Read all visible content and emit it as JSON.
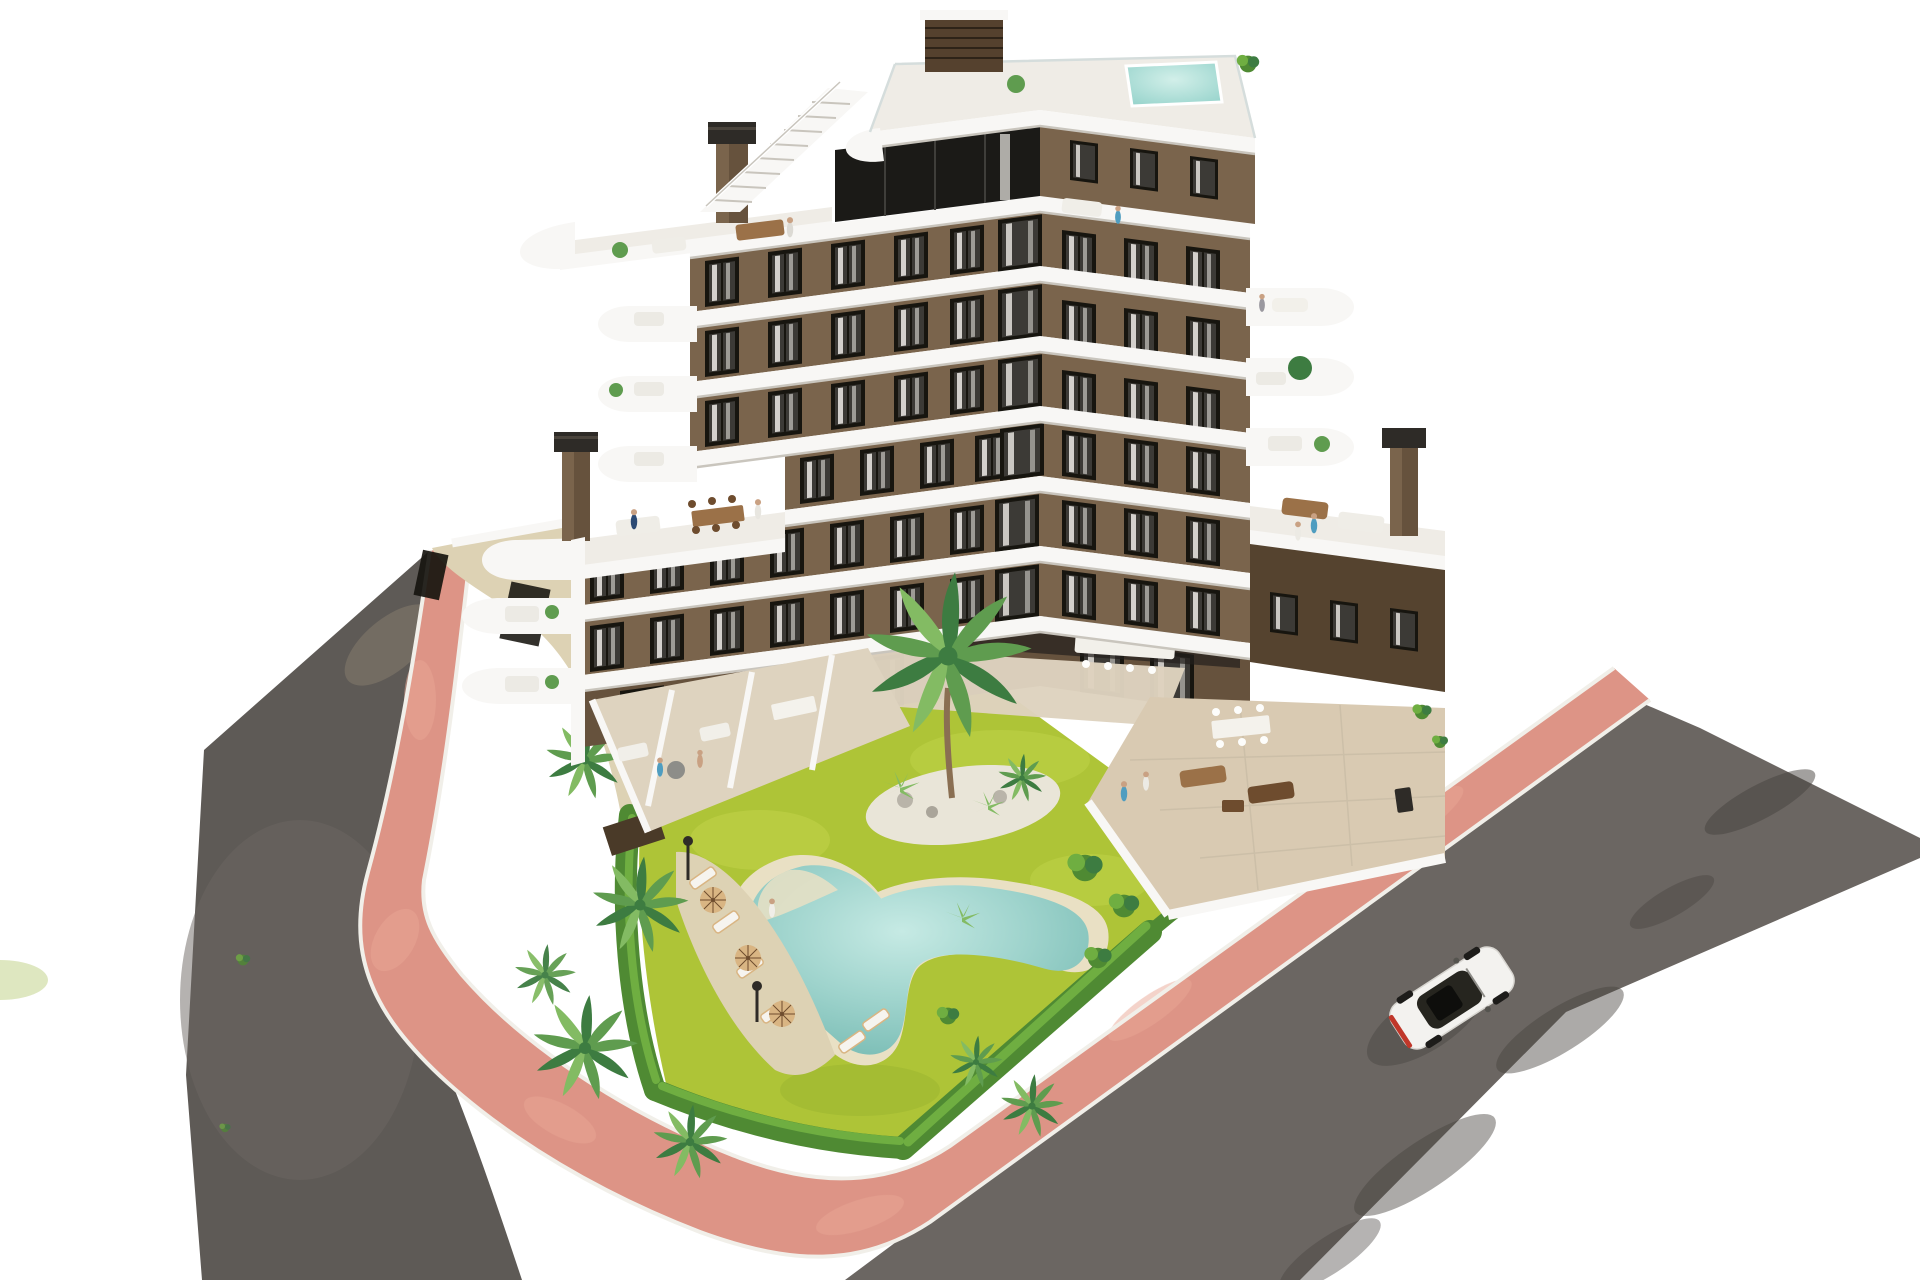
{
  "scene": {
    "type": "aerial-architectural-rendering",
    "subject": "modern white and brown apartment building with communal garden, free-form pool and rooftop terraces",
    "elements": {
      "building": {
        "floors_visible": 7,
        "style": "white curved balcony bands with brown stucco facade and dark framed windows",
        "features": [
          "rooftop-plunge-pool",
          "roof-stairs",
          "penthouse-terrace",
          "two-chimneys-on-wing-terraces",
          "rounded-corner-balconies",
          "ground-floor-terraces",
          "courtyard-palm"
        ]
      },
      "garden": {
        "features": [
          "bright-lawn",
          "free-form-pool-with-sand-rim",
          "sun-loungers",
          "parasols",
          "palm-trees",
          "perimeter-hedge",
          "pebble-island",
          "lamp-posts"
        ]
      },
      "streets": {
        "features": [
          "grey-asphalt-roads-two-sides",
          "salmon-pink-paved-sidewalk",
          "white-kerb-lines",
          "tree-shadows",
          "single-white-car"
        ]
      },
      "car": {
        "color_name": "white",
        "heading": "up-right along the right road"
      }
    }
  },
  "palette": {
    "white": "#f8f7f5",
    "whiteShade": "#e6e4df",
    "slabEdge": "#c9c5bd",
    "brown": "#7a644c",
    "brownD": "#66523d",
    "brownXD": "#55432f",
    "frame": "#17150f",
    "glass": "#3c3a36",
    "curtain": "#edebe6",
    "deck": "#efece6",
    "floorBeige": "#ded3bf",
    "floorWarm": "#d9cab2",
    "lawn": "#aec437",
    "lawnL": "#cedd55",
    "lawnD": "#93af2d",
    "hedge": "#4f8a33",
    "hedgeL": "#6fae41",
    "palmD": "#3d7c41",
    "palm": "#5f9c4f",
    "palmL": "#83bb63",
    "sand": "#ddd2b4",
    "poolRim": "#e9e0c4",
    "water": "#8fcac2",
    "waterL": "#c2e8e2",
    "pink": "#dd9486",
    "pinkL": "#e8a795",
    "curb": "#f1efe9",
    "asphalt": "#6b6662",
    "asphaltD": "#5e5a56",
    "shadow": "#46423e",
    "carBody": "#f3f2ef",
    "carGlass": "#26251f",
    "tail": "#c0372a",
    "wood": "#9b7148",
    "woodD": "#6e4c2e",
    "tan": "#d9b583",
    "metal": "#2e2b27",
    "pebble": "#e9e5d8",
    "skin": "#c9a183",
    "blue": "#4f9dc0",
    "navy": "#2c4a74",
    "grayFig": "#9a989f"
  }
}
